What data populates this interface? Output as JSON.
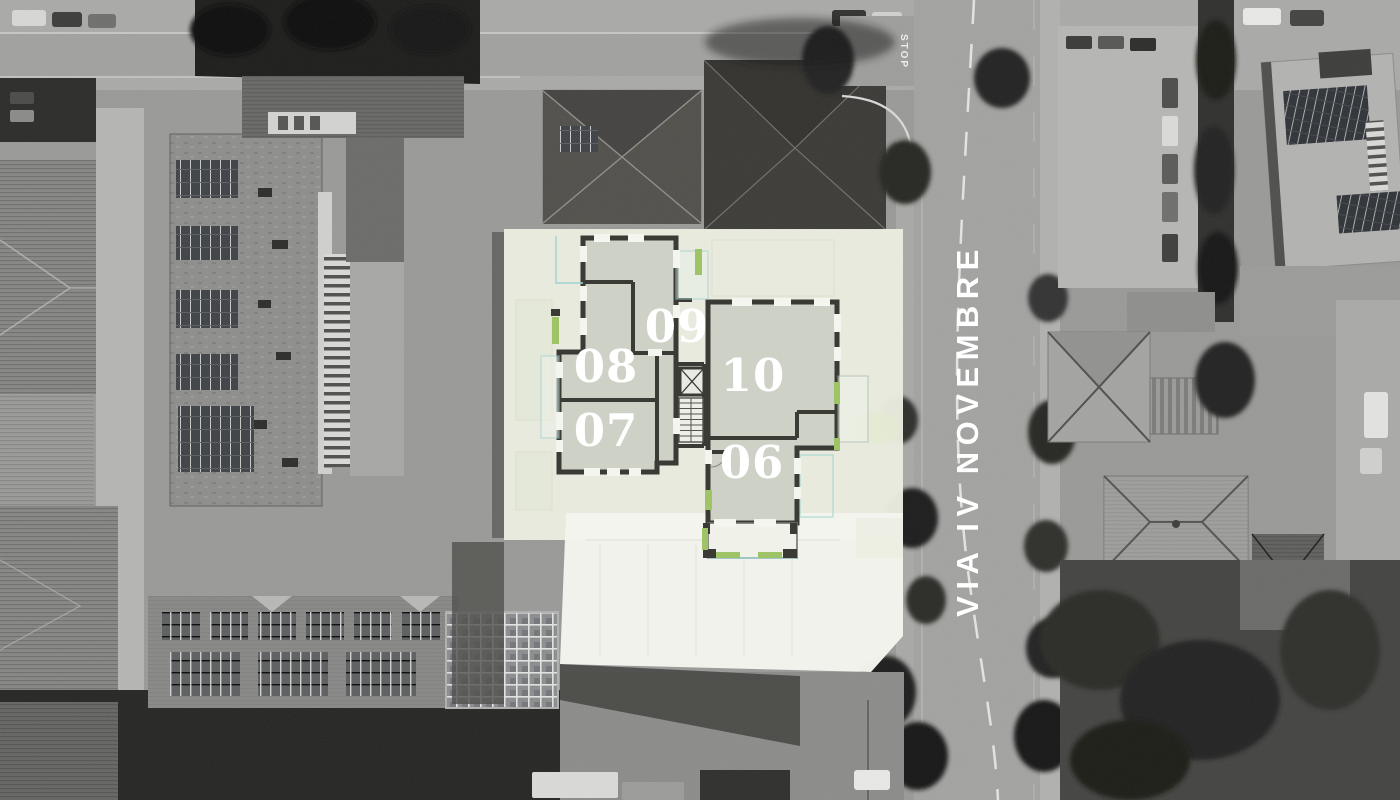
{
  "site_plan": {
    "street_label": "VIA IV NOVEMBRE",
    "road_marking": "STOP",
    "units": [
      {
        "label": "06"
      },
      {
        "label": "07"
      },
      {
        "label": "08"
      },
      {
        "label": "09"
      },
      {
        "label": "10"
      }
    ],
    "colors": {
      "plot_fill": "#e9ecdf",
      "terrace_fill": "#f3f4ee",
      "room_fill": "#ced1c5",
      "wall": "#3a3b35",
      "accent_green": "#9fc468",
      "accent_cyan": "#9ed2d2",
      "unit_label_text": "#ffffff",
      "street_text": "#ffffff"
    }
  }
}
